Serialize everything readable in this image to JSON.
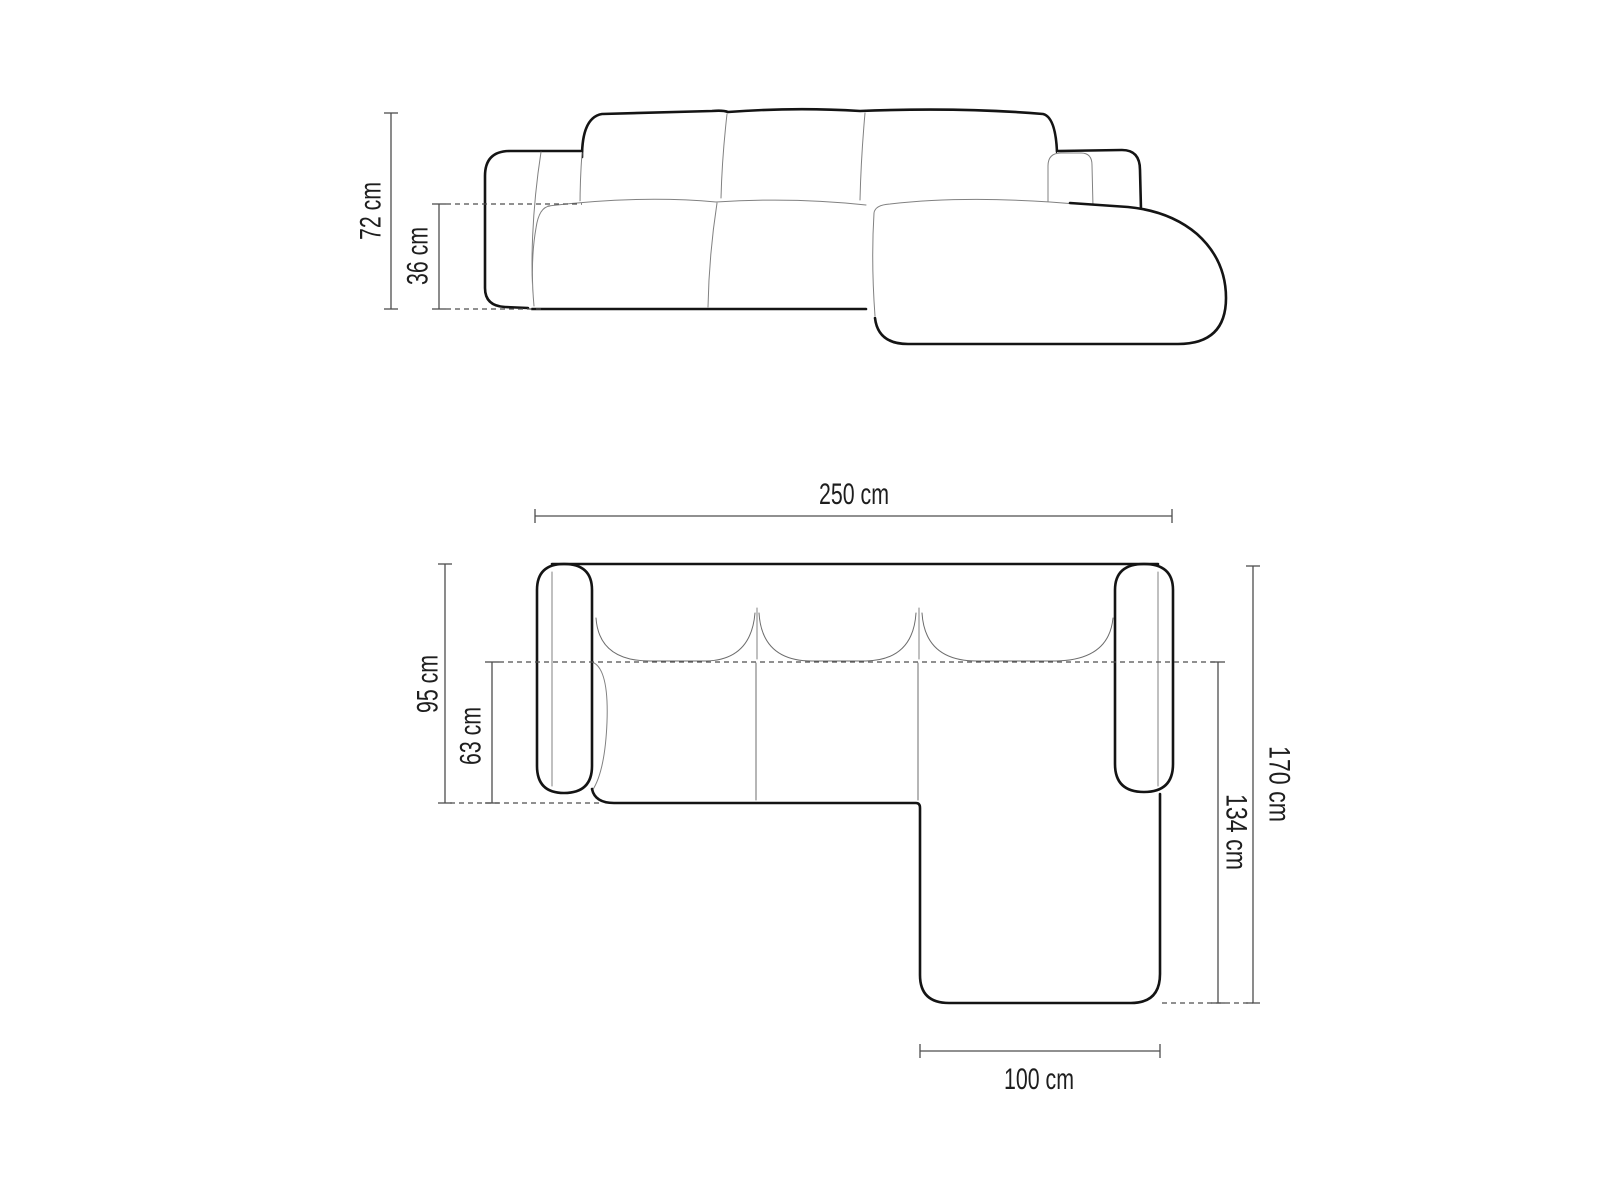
{
  "front_view": {
    "total_height": "72 cm",
    "seat_height": "36 cm"
  },
  "top_view": {
    "total_width": "250 cm",
    "total_depth": "95 cm",
    "seat_depth": "63 cm",
    "chaise_outer_length": "170 cm",
    "chaise_inner_length": "134 cm",
    "chaise_width": "100 cm"
  },
  "colors": {
    "background": "#ffffff",
    "sofa_outline_bold": "#141414",
    "sofa_seam_thin": "#818181",
    "dimension_line": "#4d4d4d",
    "label_text": "#1e1e1e"
  }
}
